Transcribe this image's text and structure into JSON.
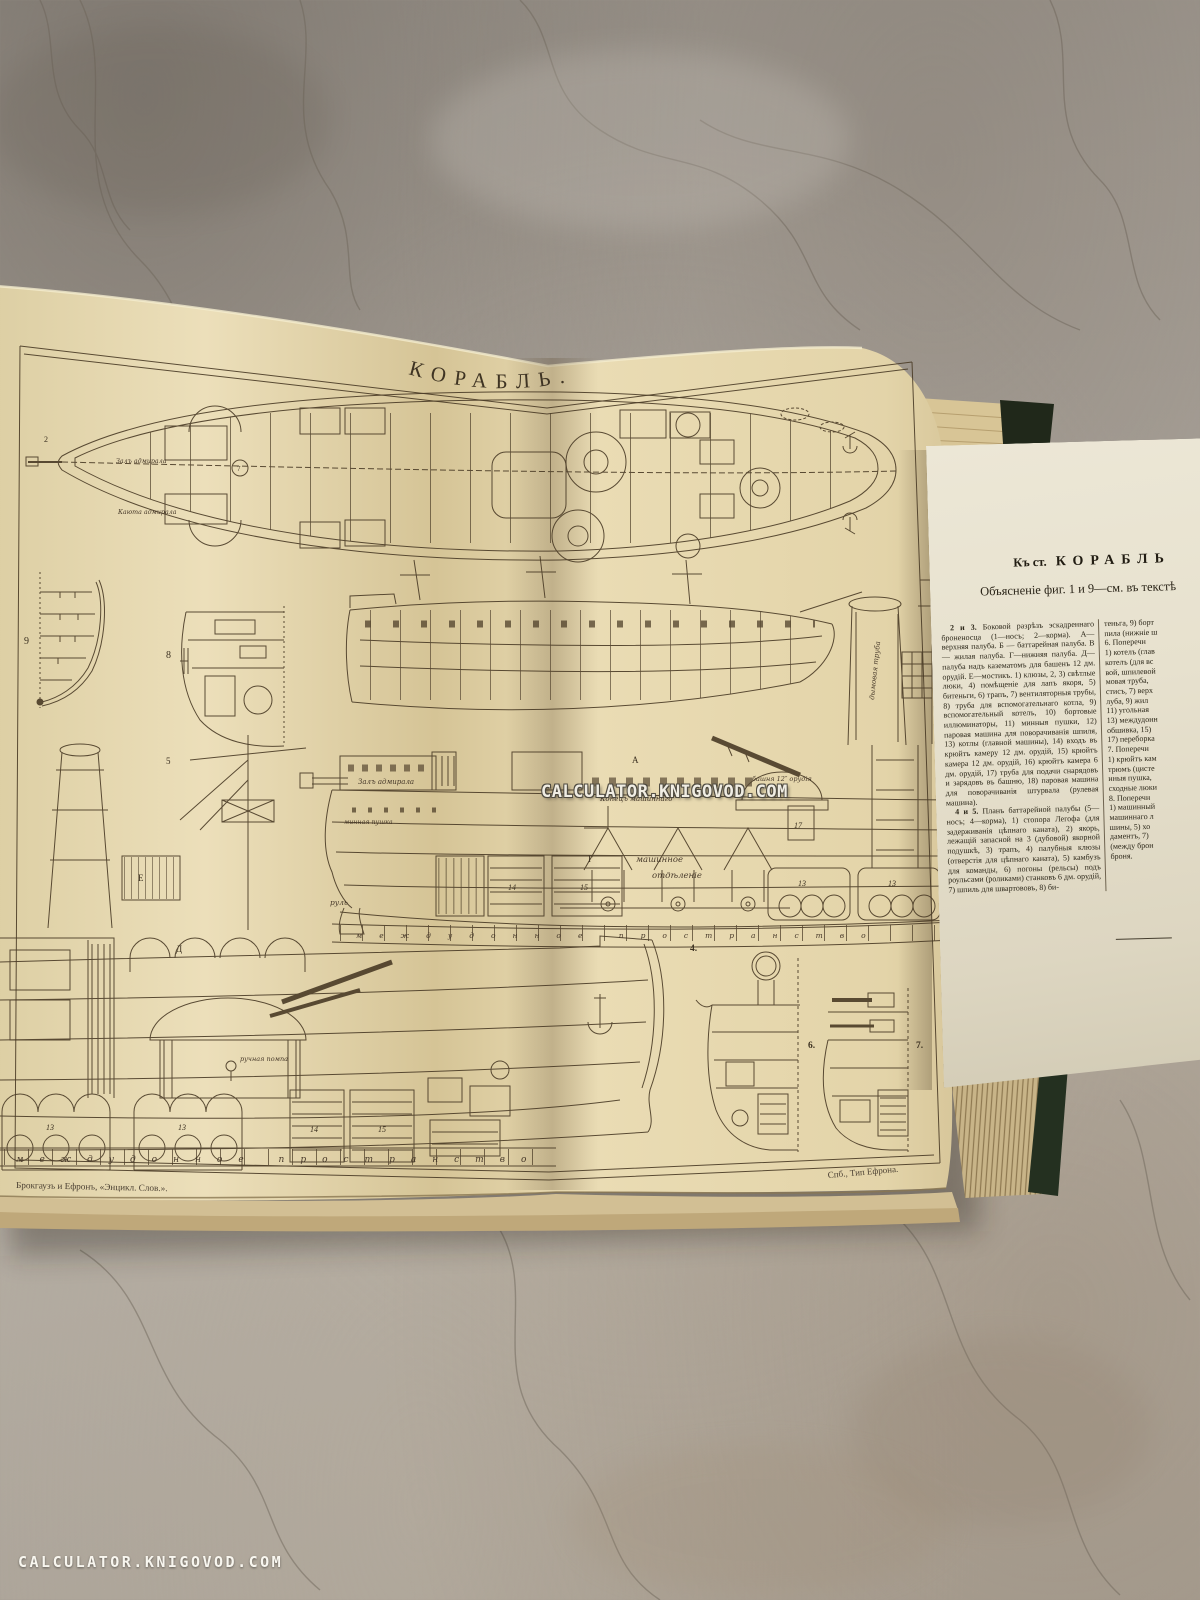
{
  "photo": {
    "watermark_center": "CALCULATOR.KNIGOVOD.COM",
    "watermark_corner": "CALCULATOR.KNIGOVOD.COM"
  },
  "plate": {
    "title": "КОРАБЛЬ.",
    "caption_left": "Брокгаузъ и Ефронъ, «Энцикл. Слов.».",
    "caption_right": "Спб., Тип Ефрона.",
    "labels": {
      "admiral_hall_plan": "Залъ адмирала",
      "admiral_cabin_plan": "Каюта адмирала",
      "admiral_hall_section": "Залъ адмирала",
      "machine_end": "Конецъ машиннаго",
      "turret": "башня 12″ орудія",
      "engine_room_line1": "машинное",
      "engine_room_line2": "отдѣленіе",
      "rudder": "руль",
      "funnel": "дымовая труба",
      "mine_gun": "минная пушка",
      "hand_pump": "ручная помпа",
      "double_bottom_upper": "междудонное пространство",
      "double_bottom_lower": "междудонное пространство"
    },
    "nums": {
      "n2": "2",
      "n4": "4.",
      "n5": "5",
      "n6": "6.",
      "n7": "7.",
      "n7c": "7",
      "n8": "8",
      "n9": "9",
      "n13": "13",
      "n14": "14",
      "n15": "15",
      "n17": "17",
      "dA": "А",
      "dG": "Г",
      "dD": "Д",
      "dE": "Е"
    }
  },
  "sheet": {
    "header_prefix": "Къ ст.",
    "header_title": "КОРАБЛЬ",
    "subheader": "Объясненіе фиг. 1 и 9—см. въ текстѣ",
    "col1": {
      "p1_label": "2 и 3.",
      "p1_text": " Боковой разрѣзъ эскадреннаго броненосца (1—носъ; 2—корма). А—верхняя палуба. Б — баттарейная палуба. В — жилая палуба. Г—нижняя палуба. Д—палуба надъ казематомъ для башенъ 12 дм. орудій. Е—мостикъ. 1) клюзы, 2, 3) свѣтлые люки, 4) помѣщеніе для лапъ якоря, 5) битеньги, 6) трапъ, 7) вентиляторныя трубы, 8) труба для вспомогательнаго котла, 9) вспомогательный котелъ, 10) бортовые иллюминаторы, 11) минныя пушки, 12) паровая машина для поворачиванія шпиля, 13) котлы (главной машины), 14) входъ въ крюйтъ камеру 12 дм. орудій, 15) крюйтъ камера 12 дм. орудій, 16) крюйтъ камера 6 дм. орудій, 17) труба для подачи снарядовъ и зарядовъ въ башню, 18) паровая машина для поворачиванія штурвала (рулевая машина).",
      "p2_label": "4 и 5.",
      "p2_text": " Планъ баттарейной палубы (5—носъ; 4—корма), 1) стопора Легофа (для задерживанія цѣпнаго каната), 2) якорь, лежащій запасной на 3 (дубовой) якорной подушкѣ, 3) трапъ, 4) палубныя клюзы (отверстія для цѣпнаго каната), 5) камбузъ для команды, 6) погоны (рельсы) подъ роульсами (роликами) станковъ 6 дм. орудій, 7) шпиль для швартововъ, 8) би-"
    },
    "col2_text": "теньга, 9) борт\nпила (нижніе ш\n6. Поперечн\n1) котелъ (глав\nкотелъ (для вс\nвой, шпилевой\nмовая труба,\nстисъ, 7) верх\nлуба, 9) жил\n11) угольная\n13) междудонн\nобшивка, 15)\n17) переборка\n7. Поперечн\n1) крюйтъ кам\nтрюмъ (цисте\nнныя пушка,\nсходные люки\n8. Поперечн\n1) машинный\nмашиннаго л\nшины, 5) хо\nдаментъ, 7)\n(между брон\nброня."
  }
}
